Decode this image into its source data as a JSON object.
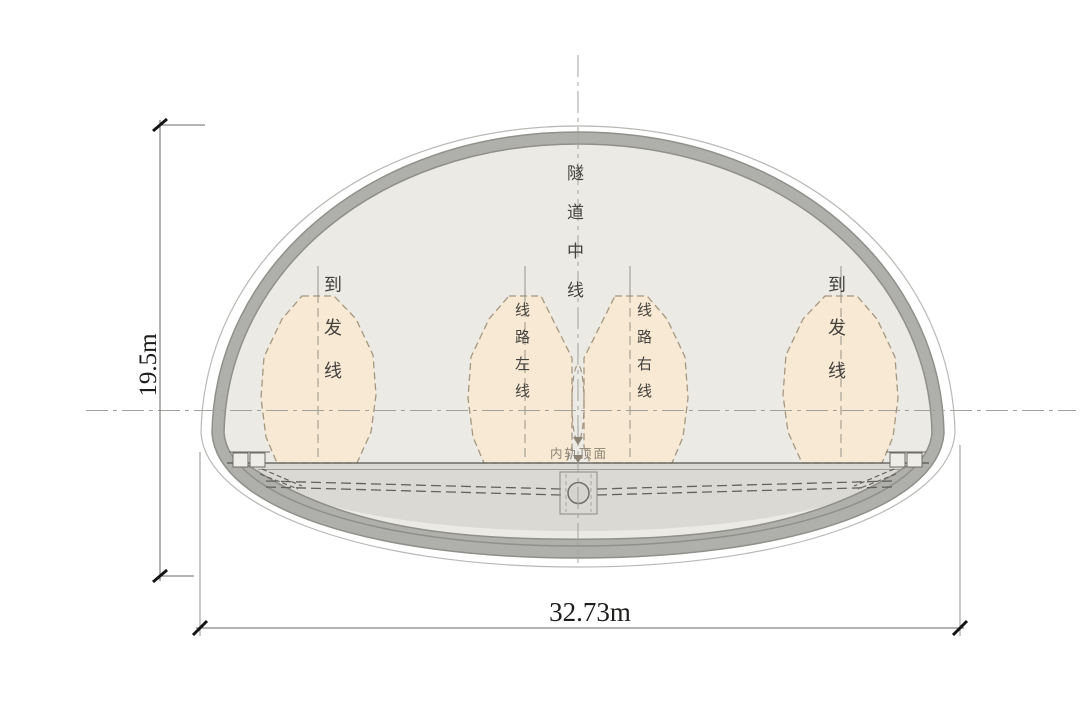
{
  "labels": {
    "tunnel_centerline": "隧道中线",
    "arrival_departure_left": "到发线",
    "route_left_line": "线路左线",
    "route_right_line": "线路右线",
    "arrival_departure_right": "到发线",
    "inner_rail_top_surface": "内轨顶面"
  },
  "dimensions": {
    "tunnel_height": "19.5m",
    "tunnel_width": "32.73m"
  },
  "colors": {
    "inner_fill": "#ECEAE4",
    "floor_fill": "#DBD9D3",
    "lining_gray": "#AFAFAB",
    "lining_edge": "#8F8F8B",
    "envelope_fill": "#F7E9D3",
    "envelope_outline": "#A6977F",
    "centerline_gray": "#A2A29C",
    "dimension_color": "#1D1D1B"
  }
}
